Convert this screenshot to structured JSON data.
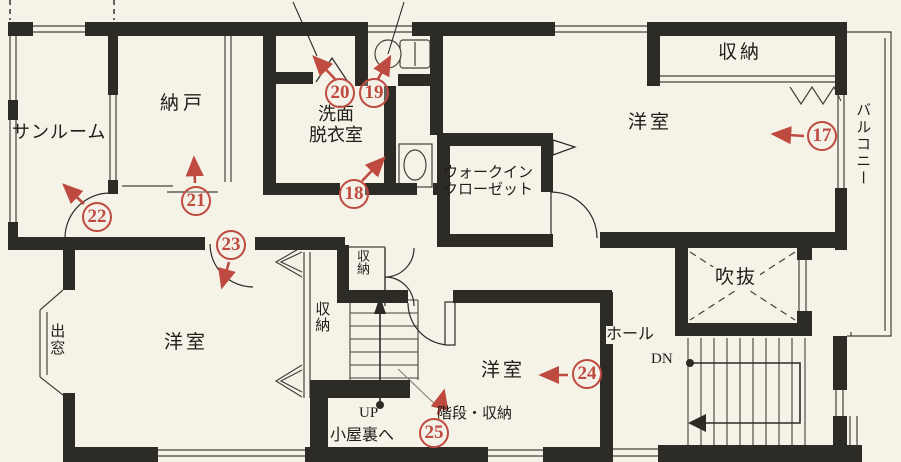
{
  "plan_type": "floor-plan",
  "colors": {
    "paper": "#f5f2e8",
    "wall": "#2d2b26",
    "line": "#45423a",
    "annotation_red": "#bf4a40"
  },
  "rooms": {
    "sunroom": "サンルーム",
    "storage_room": "納戸",
    "washroom_line1": "洗面",
    "washroom_line2": "脱衣室",
    "walkin_line1": "ウォークイン",
    "walkin_line2": "クローゼット",
    "closet_top_right": "収納",
    "bedroom_top_right": "洋室",
    "balcony": "バルコニー",
    "void_space": "吹抜",
    "hall": "ホール",
    "down_label": "DN",
    "bay_window": "出窓",
    "bedroom_bottom_left": "洋室",
    "closet_strip": "収納",
    "closet_small": "収納",
    "bedroom_bottom_center": "洋室",
    "up_label": "UP",
    "to_attic": "小屋裏へ",
    "stairs_storage": "階段・収納"
  },
  "markers": [
    {
      "number": "17"
    },
    {
      "number": "18"
    },
    {
      "number": "19"
    },
    {
      "number": "20"
    },
    {
      "number": "21"
    },
    {
      "number": "22"
    },
    {
      "number": "23"
    },
    {
      "number": "24"
    },
    {
      "number": "25"
    }
  ]
}
